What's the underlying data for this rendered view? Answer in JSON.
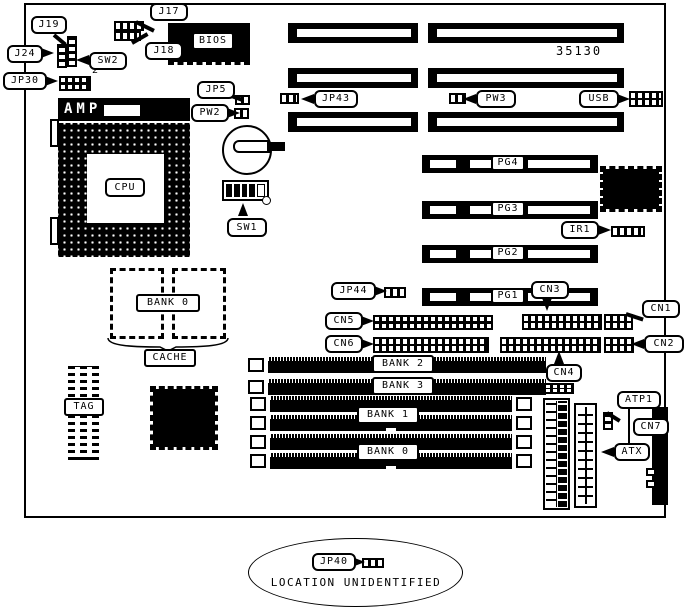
{
  "board": {
    "part_number": "35130",
    "jp30_pin_label": "2",
    "footer_note": "LOCATION UNIDENTIFIED",
    "callouts": {
      "j17": "J17",
      "j18": "J18",
      "j19": "J19",
      "j24": "J24",
      "sw2": "SW2",
      "jp30": "JP30",
      "jp5": "JP5",
      "pw2": "PW2",
      "jp43": "JP43",
      "pw3": "PW3",
      "usb": "USB",
      "ir1": "IR1",
      "sw1": "SW1",
      "jp44": "JP44",
      "cn5": "CN5",
      "cn6": "CN6",
      "cn3": "CN3",
      "cn1": "CN1",
      "cn2": "CN2",
      "cn4": "CN4",
      "atp1": "ATP1",
      "cn7": "CN7",
      "atx": "ATX",
      "jp40": "JP40"
    },
    "chips": {
      "bios": "BIOS",
      "amp": "AMP",
      "cpu": "CPU",
      "tag": "TAG",
      "cache_bank": "BANK 0",
      "cache": "CACHE"
    },
    "slots": {
      "pg4": "PG4",
      "pg3": "PG3",
      "pg2": "PG2",
      "pg1": "PG1"
    },
    "memory": {
      "bank2": "BANK 2",
      "bank3": "BANK 3",
      "bank1": "BANK 1",
      "bank0": "BANK 0"
    }
  }
}
